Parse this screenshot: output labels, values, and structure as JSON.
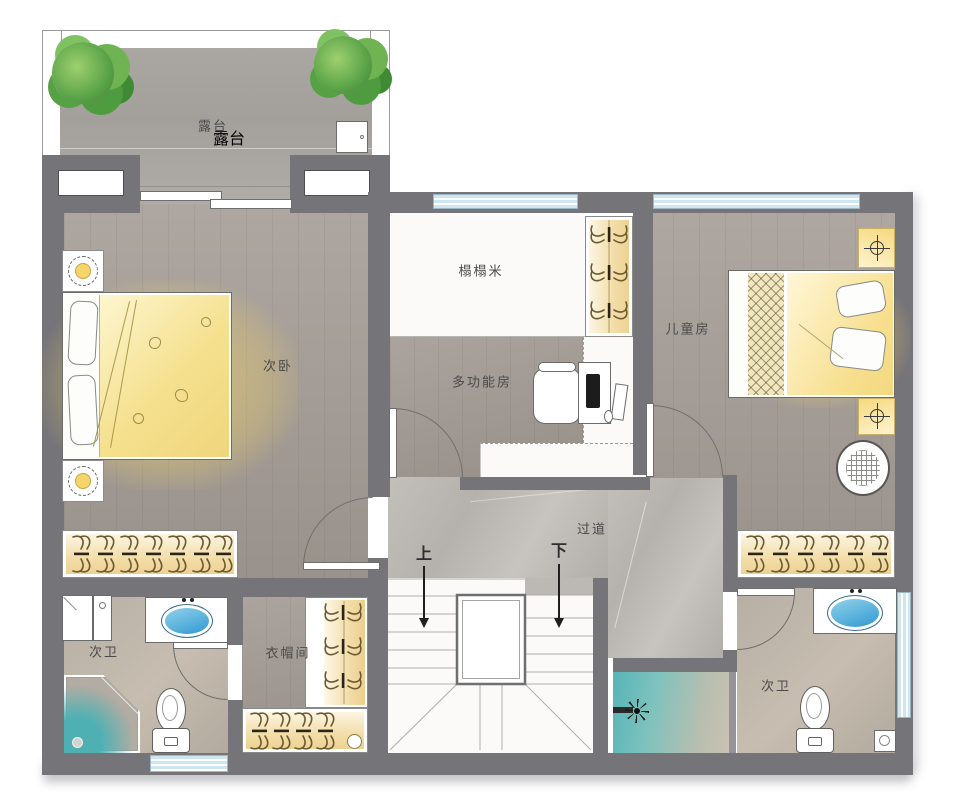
{
  "rooms": {
    "terrace": {
      "label": "露台"
    },
    "secondary_bedroom": {
      "label": "次卧"
    },
    "tatami": {
      "label": "榻榻米"
    },
    "multifunction_room": {
      "label": "多功能房"
    },
    "children_room": {
      "label": "儿童房"
    },
    "corridor": {
      "label": "过道"
    },
    "cloakroom": {
      "label": "衣帽间"
    },
    "bathroom_left": {
      "label": "次卫"
    },
    "bathroom_right": {
      "label": "次卫"
    }
  },
  "stairs": {
    "up_label": "上",
    "down_label": "下"
  },
  "palette": {
    "wall": "#757479",
    "wood_floor": "#a59d96",
    "marble_floor": "#bcb8b3",
    "tatami_floor": "#fbfaf8",
    "terrace_floor": "#a8a5a0",
    "wardrobe_fill": "#f3dda8",
    "window_fill": "#cde6f0",
    "bed_glow": "#f8d862",
    "shower_teal": "#57b4b8",
    "plant_green": "#5aa348"
  }
}
